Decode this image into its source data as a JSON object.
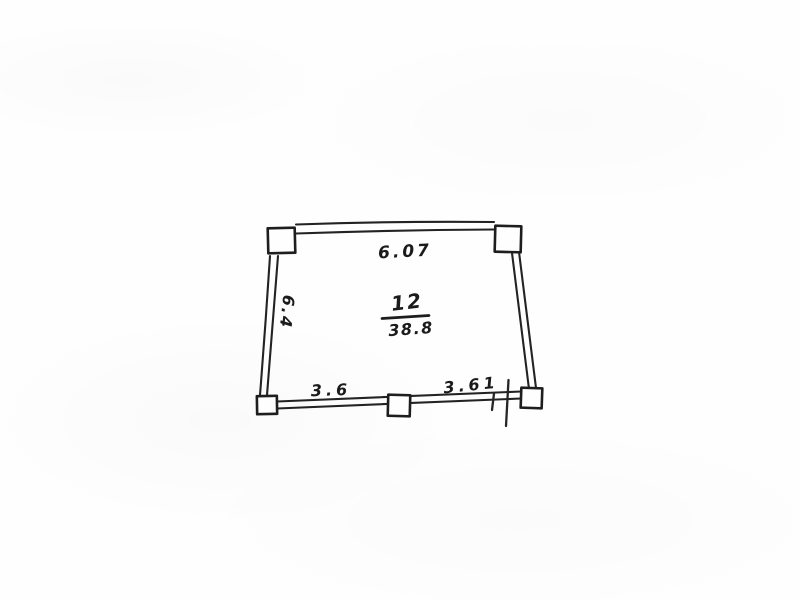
{
  "floor_plan": {
    "room": {
      "number": "12",
      "area": "38.8"
    },
    "dimensions": {
      "top_wall": "6.07",
      "left_wall": "6.4",
      "bottom_wall_left": "3.6",
      "bottom_wall_right": "3.61"
    },
    "style": {
      "ink_color": "#222222",
      "paper_color": "#fdfdfd"
    }
  }
}
